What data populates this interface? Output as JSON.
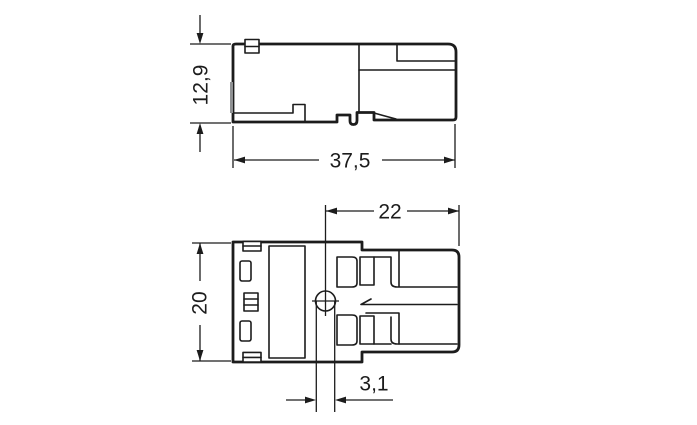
{
  "drawing": {
    "type": "technical-dimension-drawing",
    "side_view": {
      "label": "side view",
      "dim_height": "12,9",
      "dim_width": "37,5"
    },
    "plan_view": {
      "label": "top view",
      "dim_height": "20",
      "dim_width_right": "22",
      "dim_hole_offset": "3,1"
    },
    "colors": {
      "line": "#1c1c1c",
      "lever_orange": "#f1a469",
      "edge_gray": "#8f9193",
      "background": "#ffffff"
    }
  }
}
